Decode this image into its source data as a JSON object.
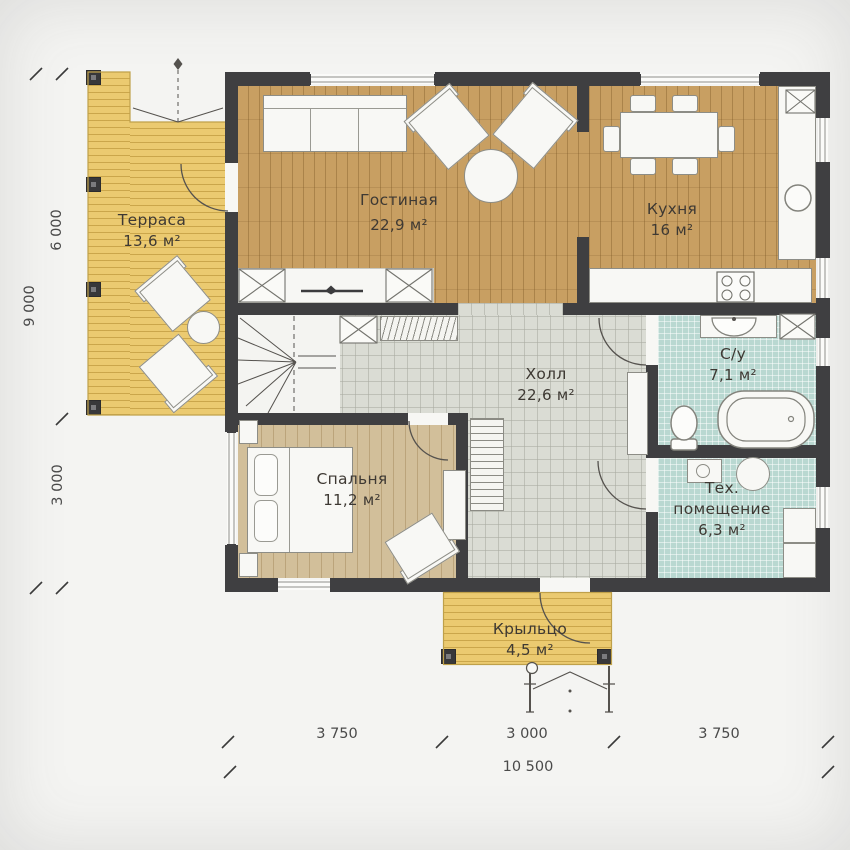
{
  "plan_title": "single-storey house floor plan",
  "palette": {
    "wall": "#3f3f41",
    "wood_floor": "#c89f62",
    "bedroom_floor": "#d2bf9a",
    "deck": "#ebca70",
    "hall_tile": "#dadcd4",
    "wet_tile": "#b9d8d1",
    "furniture_fill": "#f8f8f5",
    "furniture_stroke": "#8d8d86",
    "label_text": "#3e3933",
    "dimension_text": "#4a4a4a",
    "background": "#f4f4f2"
  },
  "rooms": [
    {
      "id": "terrace",
      "label": "Терраса",
      "area": "13,6 м²"
    },
    {
      "id": "living",
      "label": "Гостиная",
      "area": "22,9 м²"
    },
    {
      "id": "kitchen",
      "label": "Кухня",
      "area": "16 м²"
    },
    {
      "id": "hall",
      "label": "Холл",
      "area": "22,6 м²"
    },
    {
      "id": "bath",
      "label": "С/у",
      "area": "7,1 м²"
    },
    {
      "id": "bedroom",
      "label": "Спальня",
      "area": "11,2 м²"
    },
    {
      "id": "tech",
      "label": "Тех. помещение",
      "area": "6,3 м²"
    },
    {
      "id": "porch",
      "label": "Крыльцо",
      "area": "4,5 м²"
    }
  ],
  "dimensions": {
    "left": [
      {
        "label": "6 000"
      },
      {
        "label": "9 000"
      },
      {
        "label": "3 000"
      }
    ],
    "bottom": [
      {
        "label": "3 750"
      },
      {
        "label": "3 000"
      },
      {
        "label": "3 750"
      },
      {
        "label": "10 500"
      }
    ]
  }
}
